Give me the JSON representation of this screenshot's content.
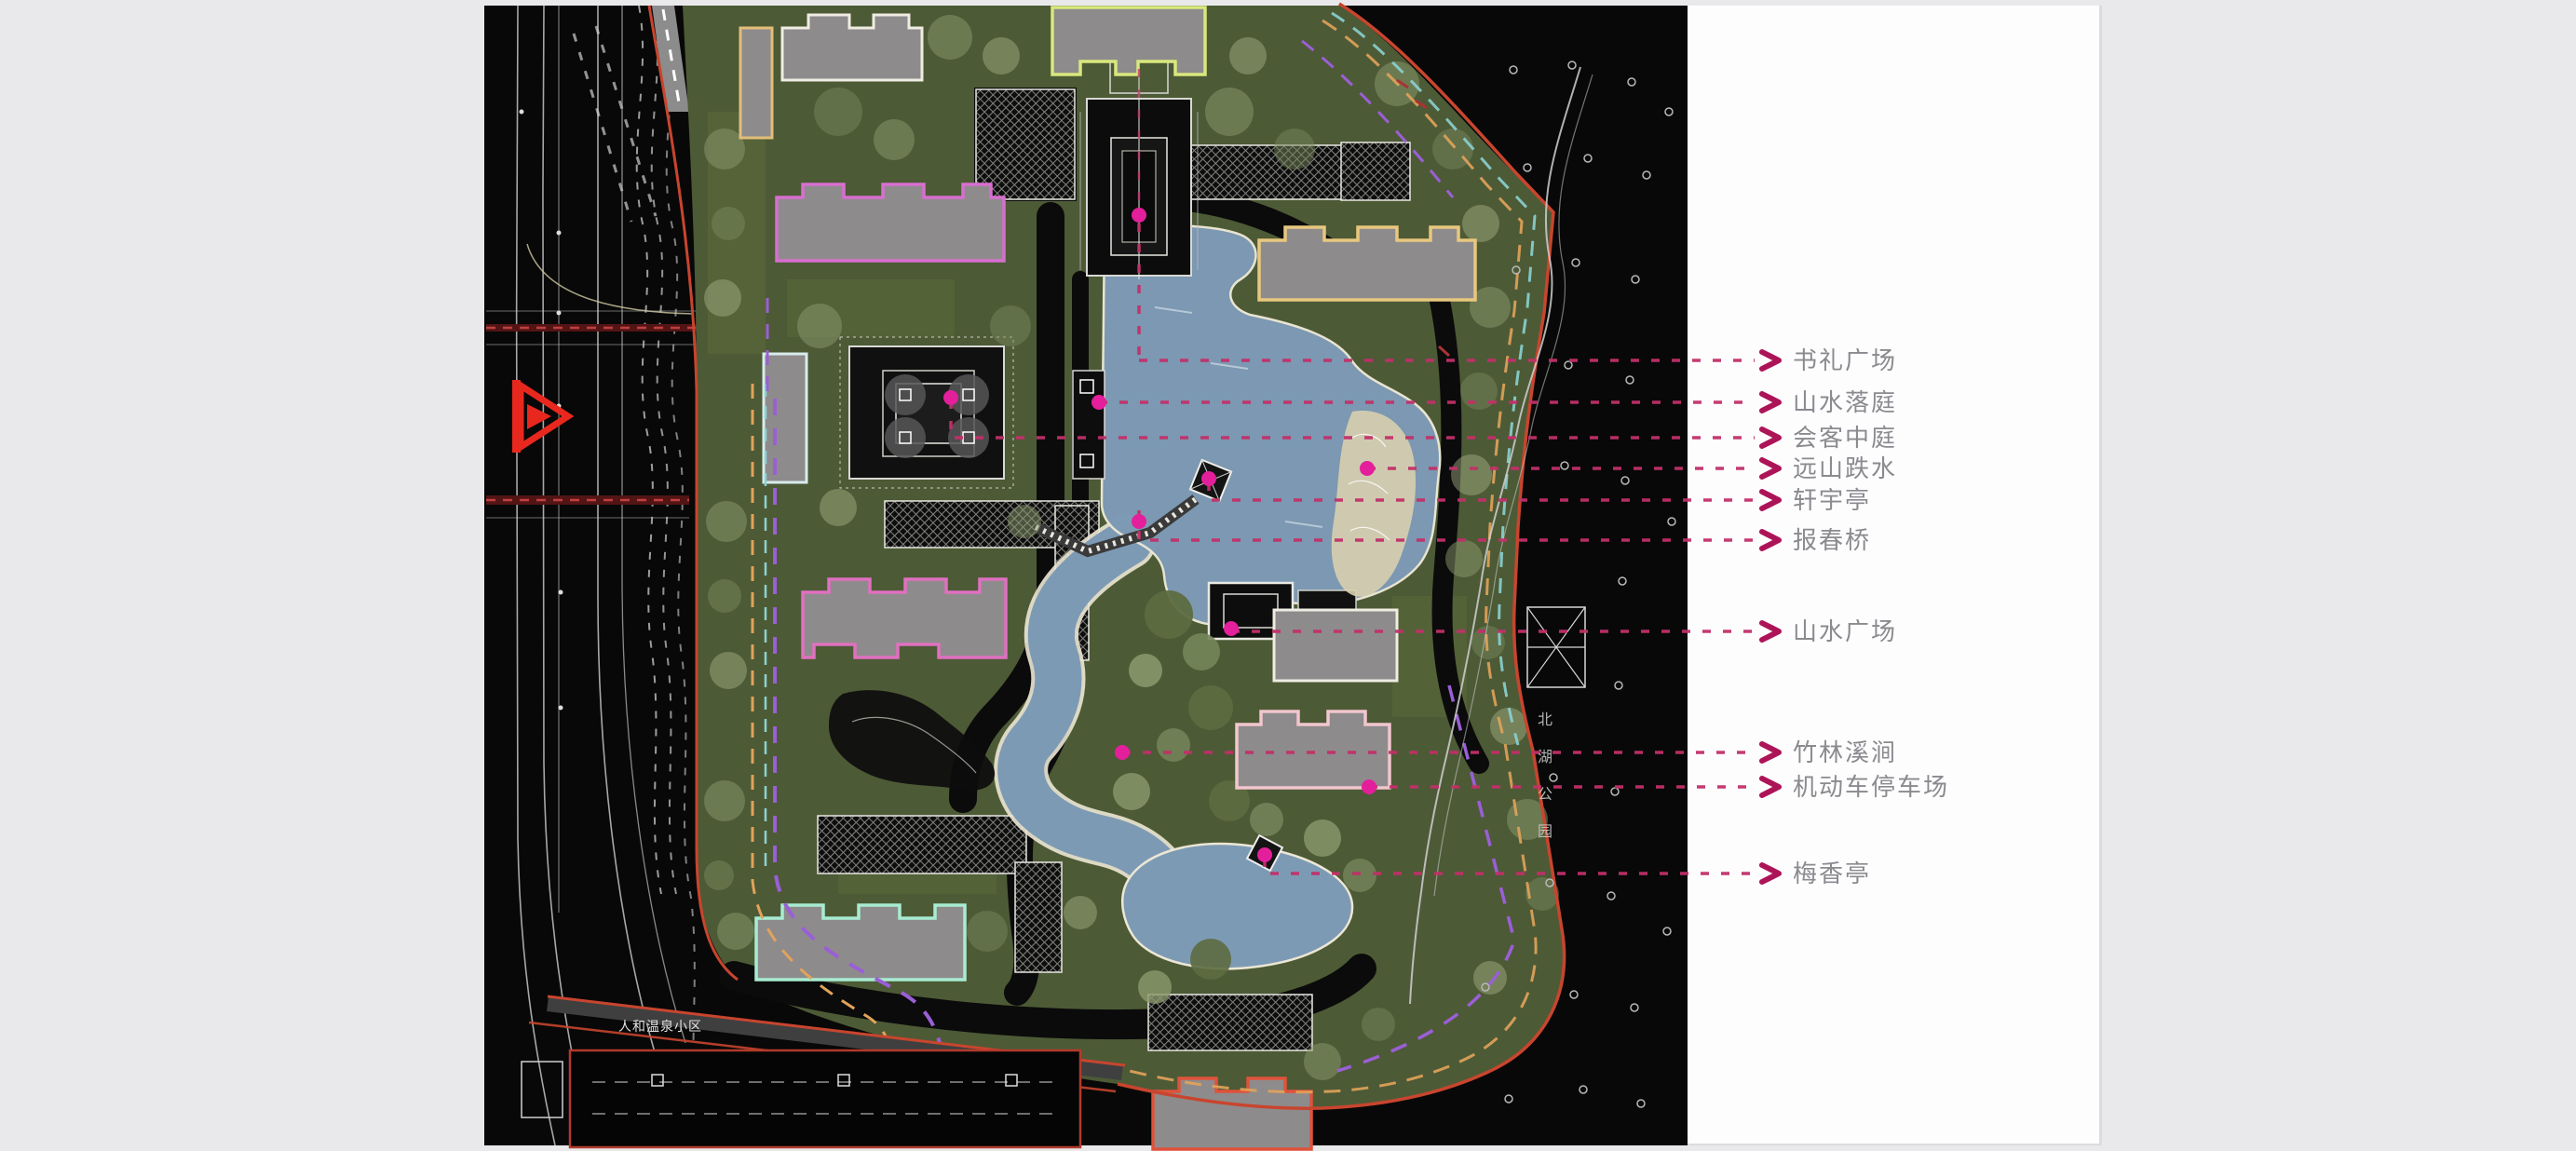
{
  "scene": {
    "type": "landscape-masterplan-slide",
    "background": "#e9e9eb",
    "slide_background": "#fdfdfe",
    "plan_background": "#080808"
  },
  "annotations": {
    "label_color": "#8a8a8f",
    "leader_line_color": "#c2306a",
    "arrow_color": "#ad1457",
    "feature_dot_color": "#e41f9b",
    "labels": [
      {
        "text": "书礼广场"
      },
      {
        "text": "山水落庭"
      },
      {
        "text": "会客中庭"
      },
      {
        "text": "远山跌水"
      },
      {
        "text": "轩宇亭"
      },
      {
        "text": "报春桥"
      },
      {
        "text": "山水广场"
      },
      {
        "text": "竹林溪涧"
      },
      {
        "text": "机动车停车场"
      },
      {
        "text": "梅香亭"
      }
    ]
  },
  "map_texts": {
    "park_name_vertical": "北湖公园",
    "neighborhood_name": "人和温泉小区"
  },
  "palette": {
    "parcel_green": "#4d5a36",
    "lake_blue": "#7d9ab5",
    "building_gray": "#8e8b8c",
    "boundary_red": "#c8452e",
    "shoreline_cream": "#ece7d4"
  }
}
